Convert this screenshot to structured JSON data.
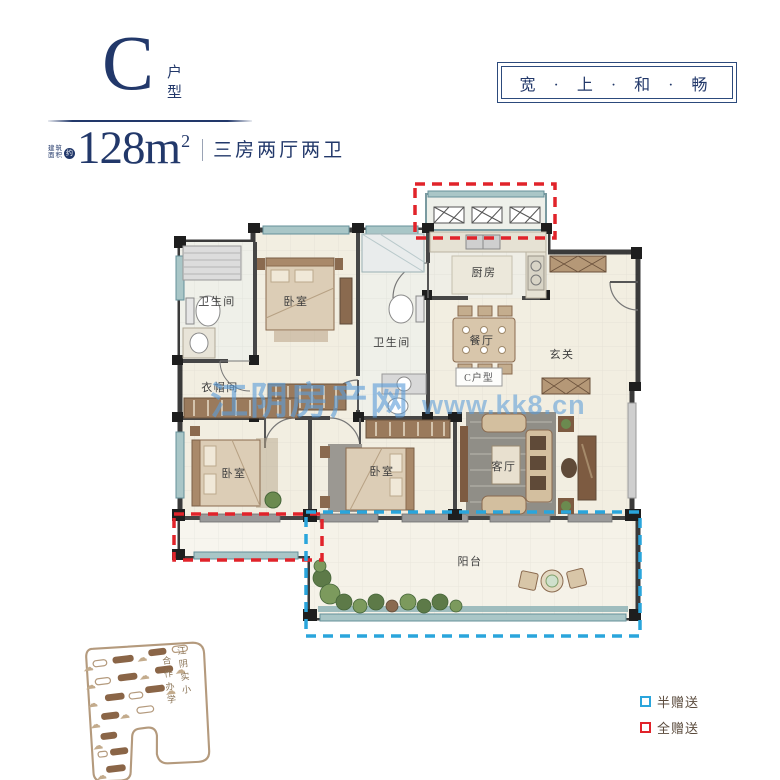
{
  "header": {
    "unit_letter": "C",
    "unit_type": "户型",
    "area_label_line1": "建筑",
    "area_label_line2": "面积",
    "area_approx": "约",
    "area_value": "128m",
    "area_exponent": "2",
    "layout_desc": "三房两厅两卫",
    "slogan": "宽 · 上 · 和 · 畅"
  },
  "watermark": {
    "site_name": "江阴房产网",
    "site_url": "www.kk8.cn"
  },
  "floorplan": {
    "badge": "C户型",
    "rooms": {
      "bathroom1": "卫生间",
      "bedroom1": "卧室",
      "bathroom2": "卫生间",
      "kitchen": "厨房",
      "dining": "餐厅",
      "foyer": "玄关",
      "cloakroom": "衣帽间",
      "bedroom2": "卧室",
      "bedroom3": "卧室",
      "living": "客厅",
      "balcony": "阳台"
    },
    "colors": {
      "wall": "#3a3a3a",
      "floor": "#f2eee1",
      "window": "#a9c6c7",
      "gift_half": "#2aa5dc",
      "gift_full": "#e1232a"
    }
  },
  "site_sketch": {
    "column_right": "江阴实小",
    "column_left": "合作办学",
    "tree_icon": "☁"
  },
  "legend": {
    "half": {
      "label": "半赠送",
      "color": "#2aa5dc"
    },
    "full": {
      "label": "全赠送",
      "color": "#e1232a"
    }
  }
}
